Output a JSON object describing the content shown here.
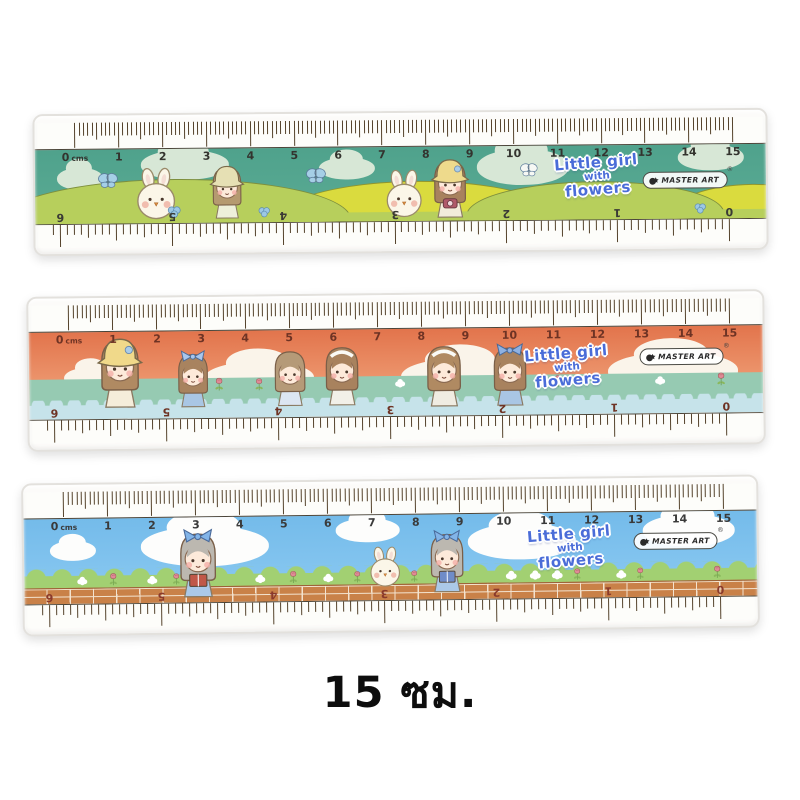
{
  "product": {
    "caption": "15 ซม."
  },
  "brand": {
    "name": "MASTER ART",
    "reg": "®"
  },
  "title_lines": [
    "Little girl",
    "with",
    "flowers"
  ],
  "scale": {
    "unit_label": "cms",
    "cm_labels": [
      "0",
      "1",
      "2",
      "3",
      "4",
      "5",
      "6",
      "7",
      "8",
      "9",
      "10",
      "11",
      "12",
      "13",
      "14",
      "15"
    ],
    "inch_labels_inverted": [
      "6",
      "5",
      "4",
      "3",
      "2",
      "1",
      "0"
    ]
  },
  "rulers": [
    {
      "name": "meadow",
      "description": "teal-sky meadow with bunnies, girls and butterflies",
      "colors": {
        "sky": "#4fa28c",
        "sky2": "#5bab94",
        "cloud": "#d7e7d6",
        "hill_green": "#b7cf5c",
        "hill_yellow": "#dadb3e",
        "number": "#33332e",
        "inv_number": "#3a3a35"
      },
      "clouds": [
        {
          "cm": 0.1,
          "w": 46,
          "h": 22,
          "top": 24
        },
        {
          "cm": 2.5,
          "w": 88,
          "h": 30,
          "top": 2
        },
        {
          "cm": 6.2,
          "w": 56,
          "h": 22,
          "top": 14
        },
        {
          "cm": 10.2,
          "w": 92,
          "h": 36,
          "top": 4
        },
        {
          "cm": 14.5,
          "w": 66,
          "h": 26,
          "top": 0
        }
      ],
      "characters": [
        {
          "type": "butterfly",
          "cm": 0.75,
          "top": 30,
          "size": 18,
          "color": "#a5cfe6"
        },
        {
          "type": "bunny",
          "cm": 1.85,
          "size": 54,
          "b": 2
        },
        {
          "type": "clover",
          "cm": 2.25,
          "size": 15,
          "b": 4
        },
        {
          "type": "girl",
          "cm": 3.45,
          "size": 58,
          "b": 3,
          "hair": "#b59a70",
          "hat": "bucket",
          "hatColor": "#e6e0b4",
          "dress": "#eef0da"
        },
        {
          "type": "clover",
          "cm": 4.3,
          "size": 13,
          "b": 4
        },
        {
          "type": "butterfly",
          "cm": 5.5,
          "top": 26,
          "size": 18,
          "color": "#a5cfe6"
        },
        {
          "type": "bunny",
          "cm": 7.5,
          "size": 50,
          "b": 2
        },
        {
          "type": "girl",
          "cm": 8.55,
          "size": 64,
          "b": 2,
          "hair": "#a8825e",
          "hat": "bucket",
          "hatColor": "#eeda8c",
          "patch": true,
          "dress": "#f2ecda",
          "prop": "camera",
          "propColor": "#b05a6a"
        },
        {
          "type": "butterfly",
          "cm": 10.35,
          "top": 22,
          "size": 16,
          "color": "#f6f8f4"
        },
        {
          "type": "clover",
          "cm": 14.25,
          "size": 13,
          "b": 4
        }
      ]
    },
    {
      "name": "sunset",
      "description": "coral sunset sky with seven little girls on mint grass and water",
      "colors": {
        "sky": "#e2744c",
        "sky2": "#f4ae85",
        "cloud": "#faf4ea",
        "grass": "#96cab2",
        "water": "#c6e3ea",
        "number": "#6e3324",
        "inv_number": "#6e3324"
      },
      "clouds": [
        {
          "cm": 0.5,
          "w": 54,
          "h": 22,
          "top": 40
        },
        {
          "cm": 4.3,
          "w": 110,
          "h": 34,
          "top": 36
        },
        {
          "cm": 8.9,
          "w": 120,
          "h": 36,
          "top": 34
        },
        {
          "cm": 13.7,
          "w": 130,
          "h": 38,
          "top": 30
        }
      ],
      "characters": [
        {
          "type": "girl",
          "cm": 1.15,
          "size": 76,
          "b": 10,
          "hair": "#b08a62",
          "hat": "bucket",
          "hatColor": "#f0d98a",
          "patch": true,
          "dress": "#f5edda"
        },
        {
          "type": "girl",
          "cm": 2.8,
          "size": 60,
          "b": 10,
          "hair": "#a8835f",
          "hat": "bow",
          "bowColor": "#a9c6ec",
          "dress": "#a9c6e4"
        },
        {
          "type": "tulip",
          "cm": 3.4,
          "size": 15,
          "b": 26
        },
        {
          "type": "tulip",
          "cm": 4.3,
          "size": 14,
          "b": 26
        },
        {
          "type": "girl",
          "cm": 5.0,
          "size": 62,
          "b": 10,
          "hair": "#b59a78",
          "hat": "none",
          "dress": "#dce6f2"
        },
        {
          "type": "girl",
          "cm": 6.2,
          "size": 66,
          "b": 10,
          "hair": "#a8825e",
          "hat": "headband",
          "dress": "#f2f0e8"
        },
        {
          "type": "puff",
          "cm": 7.5,
          "size": 10,
          "b": 28
        },
        {
          "type": "girl",
          "cm": 8.5,
          "size": 68,
          "b": 8,
          "hair": "#b08a62",
          "hat": "headband",
          "dress": "#f0ece2"
        },
        {
          "type": "girl",
          "cm": 10.0,
          "size": 66,
          "b": 8,
          "hair": "#a8825e",
          "hat": "bow",
          "bowColor": "#8fb2e2",
          "dress": "#a9c6e4"
        },
        {
          "type": "puff",
          "cm": 10.8,
          "size": 10,
          "b": 28
        },
        {
          "type": "tulip",
          "cm": 11.1,
          "size": 14,
          "b": 26
        },
        {
          "type": "puff",
          "cm": 13.4,
          "size": 10,
          "b": 28
        },
        {
          "type": "tulip",
          "cm": 14.8,
          "size": 15,
          "b": 26
        }
      ]
    },
    {
      "name": "wall",
      "description": "blue sky, flower meadow strip and brick wall with reading girls and bunny",
      "colors": {
        "sky": "#74bbea",
        "sky2": "#8ccaf2",
        "cloud": "#fdfdfc",
        "grass": "#a2d072",
        "brick": "#c98148",
        "mortar": "#f3e3cf",
        "number": "#3a3a3a",
        "inv_number": "#8a3a2c"
      },
      "clouds": [
        {
          "cm": 0.2,
          "w": 46,
          "h": 20,
          "top": 26
        },
        {
          "cm": 3.2,
          "w": 128,
          "h": 40,
          "top": 10
        },
        {
          "cm": 6.9,
          "w": 64,
          "h": 24,
          "top": 4
        },
        {
          "cm": 10.4,
          "w": 108,
          "h": 36,
          "top": 12
        },
        {
          "cm": 14.2,
          "w": 92,
          "h": 32,
          "top": 4
        }
      ],
      "characters": [
        {
          "type": "puff",
          "cm": 0.4,
          "size": 10,
          "b": 18
        },
        {
          "type": "tulip",
          "cm": 1.1,
          "size": 14,
          "b": 17
        },
        {
          "type": "puff",
          "cm": 2.0,
          "size": 10,
          "b": 18
        },
        {
          "type": "tulip",
          "cm": 2.55,
          "size": 13,
          "b": 17
        },
        {
          "type": "girl",
          "cm": 3.05,
          "size": 72,
          "b": 4,
          "hair": "#bcb8b0",
          "hat": "bow",
          "bowColor": "#82b4e8",
          "dress": "#abc9e8",
          "prop": "book",
          "propColor": "#c05848"
        },
        {
          "type": "puff",
          "cm": 4.45,
          "size": 10,
          "b": 18
        },
        {
          "type": "tulip",
          "cm": 5.2,
          "size": 14,
          "b": 17
        },
        {
          "type": "puff",
          "cm": 6.0,
          "size": 10,
          "b": 18
        },
        {
          "type": "tulip",
          "cm": 6.65,
          "size": 13,
          "b": 17
        },
        {
          "type": "bunny",
          "cm": 7.3,
          "size": 42,
          "b": 12
        },
        {
          "type": "tulip",
          "cm": 7.95,
          "size": 13,
          "b": 17
        },
        {
          "type": "girl",
          "cm": 8.7,
          "size": 66,
          "b": 6,
          "hair": "#bcb8b0",
          "hat": "bow",
          "bowColor": "#82b4e8",
          "dress": "#abc9e8",
          "prop": "book",
          "propColor": "#6f8cc8"
        },
        {
          "type": "puff",
          "cm": 10.15,
          "size": 11,
          "b": 18
        },
        {
          "type": "puff",
          "cm": 10.7,
          "size": 11,
          "b": 18
        },
        {
          "type": "puff",
          "cm": 11.2,
          "size": 11,
          "b": 18
        },
        {
          "type": "tulip",
          "cm": 11.65,
          "size": 13,
          "b": 17
        },
        {
          "type": "puff",
          "cm": 12.65,
          "size": 10,
          "b": 18
        },
        {
          "type": "tulip",
          "cm": 13.1,
          "size": 13,
          "b": 17
        },
        {
          "type": "tulip",
          "cm": 14.85,
          "size": 14,
          "b": 17
        }
      ]
    }
  ]
}
